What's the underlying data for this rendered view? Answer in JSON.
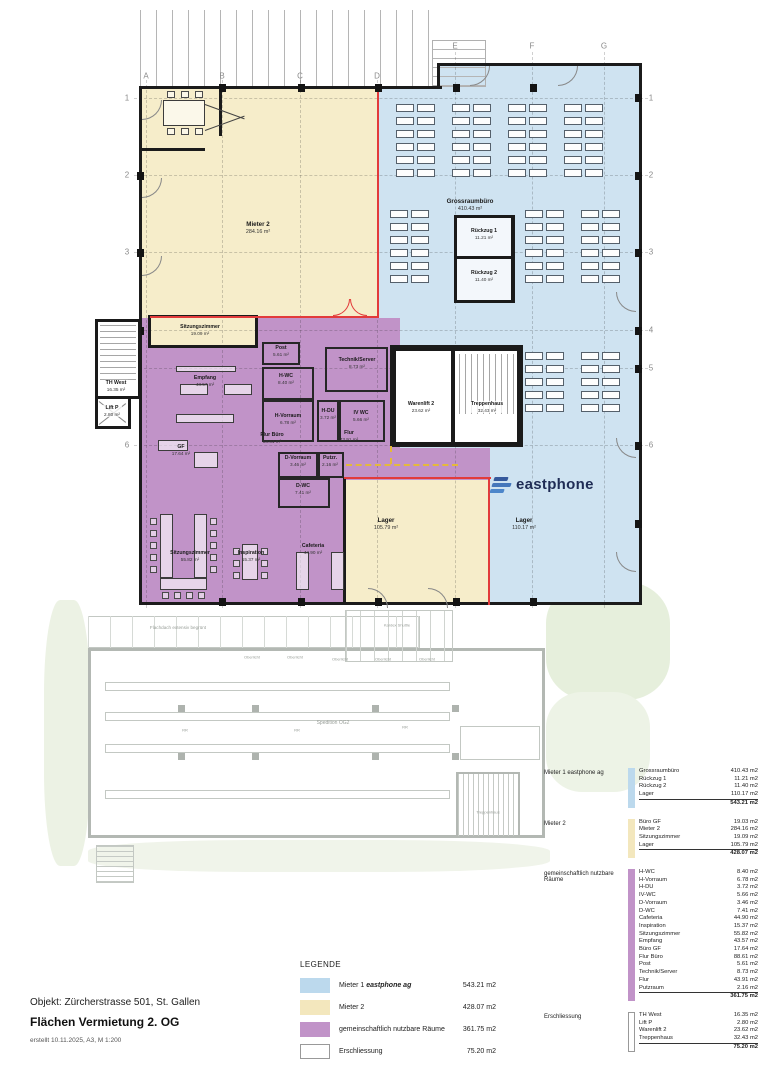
{
  "colors": {
    "mieter1_fill": "#cfe3f1",
    "mieter1_swatch": "#bcd9ed",
    "mieter2_fill": "#f6edca",
    "mieter2_swatch": "#f3e7bd",
    "common_fill": "#c193c8",
    "red_boundary": "#e23b3b",
    "logo_navy": "#1f2c55",
    "logo_blue": "#4577bb"
  },
  "plan": {
    "grid_letters": [
      "A",
      "B",
      "C",
      "D",
      "E",
      "F",
      "G"
    ],
    "grid_numbers": [
      "1",
      "2",
      "3",
      "4",
      "5",
      "6"
    ],
    "logo_text": "eastphone",
    "rooms": [
      {
        "id": "grossraumbuero",
        "label": "Grossraumbüro",
        "area": "410.43 m²"
      },
      {
        "id": "mieter2",
        "label": "Mieter 2",
        "area": "284.16 m²"
      },
      {
        "id": "rueckzug1",
        "label": "Rückzug 1",
        "area": "11.21 m²"
      },
      {
        "id": "rueckzug2",
        "label": "Rückzug 2",
        "area": "11.40 m²"
      },
      {
        "id": "sitzungszimmer-klein",
        "label": "Sitzungszimmer",
        "area": "19.09 m²"
      },
      {
        "id": "th-west",
        "label": "TH West",
        "area": "16.35 m²"
      },
      {
        "id": "lift-p",
        "label": "Lift P",
        "area": "2.80 m²"
      },
      {
        "id": "empfang",
        "label": "Empfang",
        "area": "43.57 m²"
      },
      {
        "id": "gf",
        "label": "GF",
        "area": "17.64 m²"
      },
      {
        "id": "flur-buero",
        "label": "Flur Büro",
        "area": "88.61 m²"
      },
      {
        "id": "post",
        "label": "Post",
        "area": "5.61 m²"
      },
      {
        "id": "h-wc",
        "label": "H-WC",
        "area": "8.40 m²"
      },
      {
        "id": "h-vorraum",
        "label": "H-Vorraum",
        "area": "6.78 m²"
      },
      {
        "id": "h-du",
        "label": "H-DU",
        "area": "3.72 m²"
      },
      {
        "id": "iv-wc",
        "label": "IV WC",
        "area": "5.66 m²"
      },
      {
        "id": "technik-server",
        "label": "Technik/Server",
        "area": "8.73 m²"
      },
      {
        "id": "warenlift-2",
        "label": "Warenlift 2",
        "area": "23.62 m²"
      },
      {
        "id": "treppenhaus",
        "label": "Treppenhaus",
        "area": "32.43 m²"
      },
      {
        "id": "flur",
        "label": "Flur",
        "area": "43.91 m²"
      },
      {
        "id": "d-vorraum",
        "label": "D-Vorraum",
        "area": "3.46 m²"
      },
      {
        "id": "putzraum",
        "label": "Putzr.",
        "area": "2.16 m²"
      },
      {
        "id": "d-wc",
        "label": "D-WC",
        "area": "7.41 m²"
      },
      {
        "id": "sitzungszimmer-gross",
        "label": "Sitzungszimmer",
        "area": "55.82 m²"
      },
      {
        "id": "inspiration",
        "label": "Inspiration",
        "area": "15.37 m²"
      },
      {
        "id": "cafeteria",
        "label": "Cafeteria",
        "area": "44.90 m²"
      },
      {
        "id": "lager-mieter2",
        "label": "Lager",
        "area": "105.79 m²"
      },
      {
        "id": "lager-mieter1",
        "label": "Lager",
        "area": "110.17 m²"
      }
    ]
  },
  "lower_plan": {
    "roof_label": "Flachdach extensiv begrünt",
    "hall_label": "Spedition OG2",
    "kardex_label": "Kardex Shuttle",
    "stair_label": "Treppenhaus",
    "skylight_labels": [
      "Oberlicht",
      "Oberlicht",
      "Oberlicht",
      "Oberlicht",
      "Oberlicht"
    ],
    "rack_labels": [
      "RR",
      "RR",
      "RR"
    ]
  },
  "tables": [
    {
      "title": "Mieter 1 eastphone ag",
      "color": "#bcd9ed",
      "border": "",
      "rows": [
        [
          "Grossraumbüro",
          "410.43 m2"
        ],
        [
          "Rückzug 1",
          "11.21 m2"
        ],
        [
          "Rückzug 2",
          "11.40 m2"
        ],
        [
          "Lager",
          "110.17 m2"
        ]
      ],
      "total": "543.21 m2"
    },
    {
      "title": "Mieter 2",
      "color": "#f3e7bd",
      "border": "",
      "rows": [
        [
          "Büro GF",
          "19.03 m2"
        ],
        [
          "Mieter 2",
          "284.16 m2"
        ],
        [
          "Sitzungszimmer",
          "19.09 m2"
        ],
        [
          "Lager",
          "105.79 m2"
        ]
      ],
      "total": "428.07 m2"
    },
    {
      "title": "gemeinschaftlich nutzbare Räume",
      "color": "#c193c8",
      "border": "",
      "rows": [
        [
          "H-WC",
          "8.40 m2"
        ],
        [
          "H-Vorraum",
          "6.78 m2"
        ],
        [
          "H-DU",
          "3.72 m2"
        ],
        [
          "IV-WC",
          "5.66 m2"
        ],
        [
          "D-Vorraum",
          "3.46 m2"
        ],
        [
          "D-WC",
          "7.41 m2"
        ],
        [
          "Cafeteria",
          "44.90 m2"
        ],
        [
          "Inspiration",
          "15.37 m2"
        ],
        [
          "Sitzungszimmer",
          "55.82 m2"
        ],
        [
          "Empfang",
          "43.57 m2"
        ],
        [
          "Büro GF",
          "17.64 m2"
        ],
        [
          "Flur Büro",
          "88.61 m2"
        ],
        [
          "Post",
          "5.61 m2"
        ],
        [
          "Technik/Server",
          "8.73 m2"
        ],
        [
          "Flur",
          "43.91 m2"
        ],
        [
          "Putzraum",
          "2.16 m2"
        ]
      ],
      "total": "361.75 m2"
    },
    {
      "title": "Erschliessung",
      "color": "#ffffff",
      "border": "1px solid #999",
      "rows": [
        [
          "TH West",
          "16.35 m2"
        ],
        [
          "Lift P",
          "2.80 m2"
        ],
        [
          "Warenlift 2",
          "23.62 m2"
        ],
        [
          "Treppenhaus",
          "32.43 m2"
        ]
      ],
      "total": "75.20 m2"
    }
  ],
  "legend": {
    "title": "LEGENDE",
    "items": [
      {
        "prefix": "Mieter 1 ",
        "brand": "eastphone ag",
        "area": "543.21 m2",
        "color": "#bcd9ed",
        "border": ""
      },
      {
        "prefix": "Mieter 2",
        "brand": "",
        "area": "428.07 m2",
        "color": "#f3e7bd",
        "border": ""
      },
      {
        "prefix": "gemeinschaftlich nutzbare Räume",
        "brand": "",
        "area": "361.75 m2",
        "color": "#c193c8",
        "border": ""
      },
      {
        "prefix": "Erschliessung",
        "brand": "",
        "area": "75.20 m2",
        "color": "#ffffff",
        "border": "1px solid #999"
      }
    ]
  },
  "footer": {
    "object_line": "Objekt: Zürcherstrasse 501, St. Gallen",
    "title_line": "Flächen Vermietung 2. OG",
    "created_line": "erstellt 10.11.2025, A3, M 1:200"
  }
}
